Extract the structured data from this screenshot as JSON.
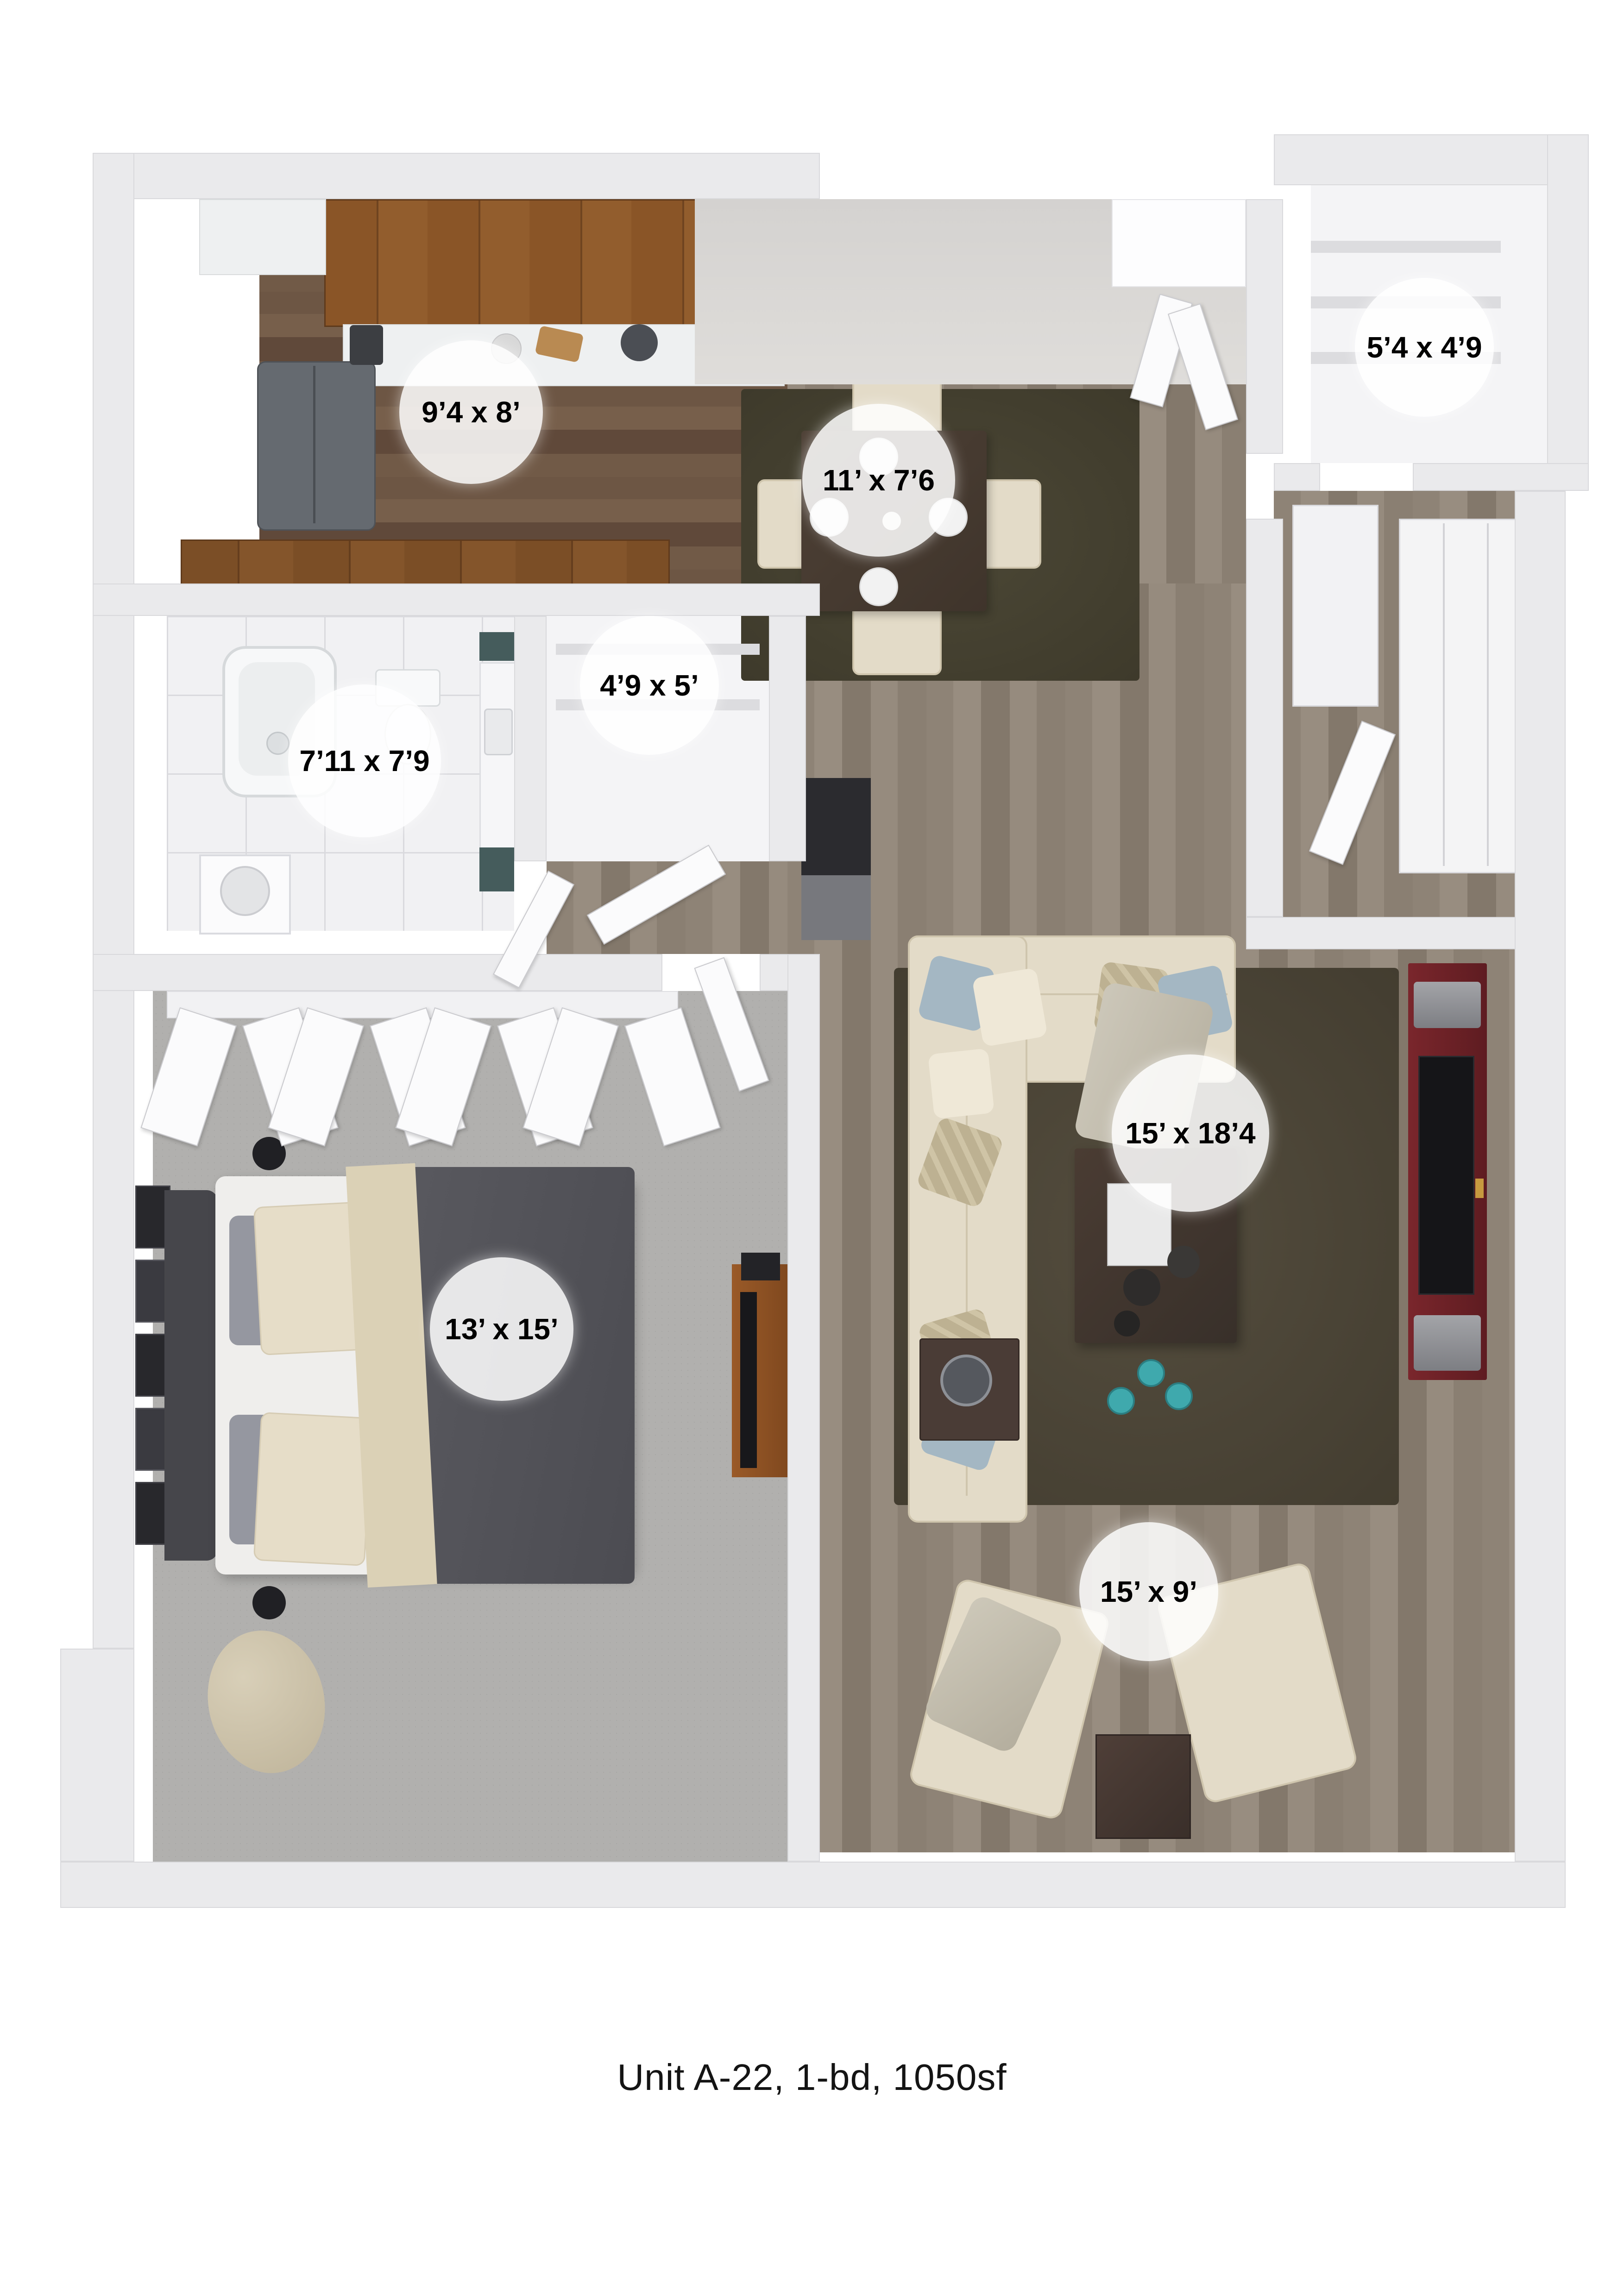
{
  "caption": "Unit A-22, 1-bd, 1050sf",
  "rooms": {
    "kitchen": {
      "dimensions": "9’4 x 8’"
    },
    "dining": {
      "dimensions": "11’ x 7’6"
    },
    "entry_closet": {
      "dimensions": "5’4 x 4’9"
    },
    "hall_closet": {
      "dimensions": "4’9 x 5’"
    },
    "bathroom": {
      "dimensions": "7’11 x 7’9"
    },
    "bedroom": {
      "dimensions": "13’ x 15’"
    },
    "living_room": {
      "dimensions": "15’ x 18’4"
    },
    "den": {
      "dimensions": "15’ x 9’"
    }
  },
  "palette": {
    "wall": "#eaeaec",
    "wall_face_shaded": "#d6d4d2",
    "kitchen_wood": "#6d5644",
    "main_wood": "#8e8376",
    "carpet": "#b1b0ae",
    "bath_tile": "#f1f1f3",
    "cabinet_wood": "#8a5527",
    "rug_dark_olive": "#45412f",
    "sofa_cream": "#e3dbc8",
    "pillow_blue": "#a4b7c3",
    "pillow_tan": "#bdb192",
    "coffee_table": "#423630",
    "tv_unit_maroon": "#6e2227",
    "tv_screen": "#151518",
    "bed_duvet": "#57575d",
    "bed_throw": "#dbd1b6",
    "bedroom_tv_stand": "#8f5023",
    "accent_teal": "#455c5c",
    "label_bg": "rgba(255,255,255,0.86)",
    "label_text": "#000000"
  }
}
